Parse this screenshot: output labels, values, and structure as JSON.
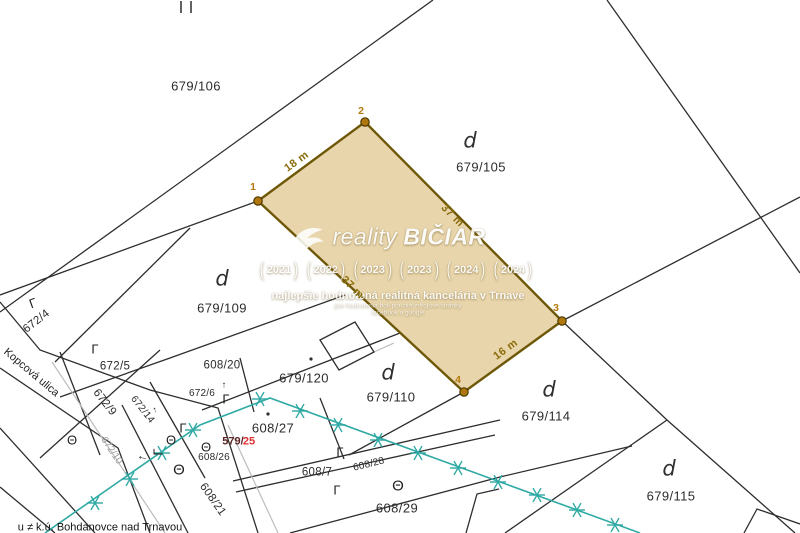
{
  "watermark": {
    "brand_prefix": "reality",
    "brand_suffix": "BIČIAR",
    "badges": [
      "2021",
      "2022",
      "2023",
      "2023",
      "2024",
      "2024"
    ],
    "slogan": "najlepšie hodnotená realitná kancelária v Trnave",
    "fine_print_line1": "pre hodnotenia boli použité zdrojové stránky",
    "fine_print_line2": "facebook a google"
  },
  "colors": {
    "parcel_fill": "#e8d5ab",
    "parcel_edge": "#6e5808",
    "corner_marker": "#b0770e",
    "utility_line": "#2fa9a4",
    "dimension_text": "#8a6d0a",
    "highlight_red": "#e03131",
    "boundary_line": "#2e2e2e",
    "road_gray": "#bdbdbd"
  },
  "labels": [
    {
      "t": "679/106",
      "x": 196,
      "y": 86,
      "c": "num",
      "n": "parcel-number-679-106"
    },
    {
      "t": "679/105",
      "x": 481,
      "y": 167,
      "c": "num",
      "n": "parcel-number-679-105"
    },
    {
      "t": "679/109",
      "x": 222,
      "y": 308,
      "c": "num",
      "n": "parcel-number-679-109"
    },
    {
      "t": "679/110",
      "x": 391,
      "y": 397,
      "c": "num",
      "n": "parcel-number-679-110"
    },
    {
      "t": "679/114",
      "x": 546,
      "y": 416,
      "c": "num",
      "n": "parcel-number-679-114"
    },
    {
      "t": "679/115",
      "x": 671,
      "y": 496,
      "c": "num",
      "n": "parcel-number-679-115"
    },
    {
      "t": "679/120",
      "x": 304,
      "y": 378,
      "c": "num",
      "n": "parcel-number-679-120"
    },
    {
      "t": "608/20",
      "x": 222,
      "y": 366,
      "c": "num-s",
      "n": "parcel-number-608-20"
    },
    {
      "t": "608/27",
      "x": 273,
      "y": 428,
      "c": "num",
      "n": "parcel-number-608-27"
    },
    {
      "t": "608/26",
      "x": 214,
      "y": 458,
      "c": "num-xs",
      "n": "parcel-number-608-26"
    },
    {
      "t": "608/7",
      "x": 317,
      "y": 473,
      "c": "num-s",
      "n": "parcel-number-608-7"
    },
    {
      "t": "608/29",
      "x": 397,
      "y": 508,
      "c": "num",
      "n": "parcel-number-608-29"
    },
    {
      "t": "608/28",
      "x": 369,
      "y": 465,
      "r": -14,
      "c": "num-xs",
      "n": "parcel-number-608-28"
    },
    {
      "t": "608/21",
      "x": 212,
      "y": 500,
      "r": 55,
      "c": "num-s",
      "n": "parcel-number-608-21"
    },
    {
      "t": "672/4",
      "x": 37,
      "y": 322,
      "r": -38,
      "c": "num-s",
      "n": "parcel-number-672-4"
    },
    {
      "t": "672/5",
      "x": 115,
      "y": 367,
      "c": "num-s",
      "n": "parcel-number-672-5"
    },
    {
      "t": "672/9",
      "x": 104,
      "y": 403,
      "r": 52,
      "c": "num-s",
      "n": "parcel-number-672-9"
    },
    {
      "t": "672/14",
      "x": 142,
      "y": 410,
      "r": 52,
      "c": "num-xs",
      "n": "parcel-number-672-14"
    },
    {
      "t": "672/6",
      "x": 202,
      "y": 394,
      "c": "num-xs",
      "n": "parcel-number-672-6"
    },
    {
      "t": "672/10",
      "x": 111,
      "y": 451,
      "r": 56,
      "c": "gray-s",
      "n": "path-number-672-10"
    },
    {
      "t": "Kopcová ulica",
      "x": 31,
      "y": 373,
      "r": 40,
      "c": "street",
      "n": "street-name-kopcova-ulica"
    },
    {
      "t": "579/",
      "x": 233,
      "y": 442,
      "c": "bold-dark",
      "n": "parcel-number-579-25-prefix"
    },
    {
      "t": "25",
      "x": 249,
      "y": 442,
      "c": "bold-red",
      "n": "parcel-number-579-25-red"
    },
    {
      "t": "d",
      "x": 470,
      "y": 141,
      "c": "dl",
      "n": "land-use-letter-d"
    },
    {
      "t": "d",
      "x": 222,
      "y": 279,
      "c": "dl",
      "n": "land-use-letter-d"
    },
    {
      "t": "d",
      "x": 388,
      "y": 373,
      "c": "dl",
      "n": "land-use-letter-d"
    },
    {
      "t": "d",
      "x": 549,
      "y": 390,
      "c": "dl",
      "n": "land-use-letter-d"
    },
    {
      "t": "d",
      "x": 669,
      "y": 469,
      "c": "dl",
      "n": "land-use-letter-d"
    },
    {
      "t": "18 m",
      "x": 297,
      "y": 162,
      "r": -36,
      "c": "dim",
      "n": "dimension-18m"
    },
    {
      "t": "37 m",
      "x": 452,
      "y": 216,
      "r": 45,
      "c": "dim",
      "n": "dimension-37m"
    },
    {
      "t": "37 m",
      "x": 352,
      "y": 288,
      "r": 45,
      "c": "dim",
      "n": "dimension-37m-left"
    },
    {
      "t": "16 m",
      "x": 506,
      "y": 350,
      "r": -36,
      "c": "dim",
      "n": "dimension-16m"
    },
    {
      "t": "1",
      "x": 253,
      "y": 187,
      "c": "corner",
      "n": "corner-point-label-1"
    },
    {
      "t": "2",
      "x": 361,
      "y": 111,
      "c": "corner",
      "n": "corner-point-label-2"
    },
    {
      "t": "3",
      "x": 556,
      "y": 308,
      "c": "corner",
      "n": "corner-point-label-3"
    },
    {
      "t": "4",
      "x": 458,
      "y": 380,
      "c": "corner",
      "n": "corner-point-label-4"
    },
    {
      "t": "Γ",
      "x": 33,
      "y": 303,
      "r": -20,
      "c": "sym",
      "n": "land-use-symbol-gamma"
    },
    {
      "t": "Γ",
      "x": 95,
      "y": 349,
      "c": "sym",
      "n": "land-use-symbol-gamma"
    },
    {
      "t": "Γ",
      "x": 226,
      "y": 399,
      "c": "sym",
      "n": "land-use-symbol-gamma"
    },
    {
      "t": "Γ",
      "x": 183,
      "y": 428,
      "c": "sym",
      "n": "land-use-symbol-gamma"
    },
    {
      "t": "Γ",
      "x": 158,
      "y": 452,
      "r": -90,
      "c": "sym",
      "n": "land-use-symbol-gamma"
    },
    {
      "t": "Γ",
      "x": 340,
      "y": 452,
      "c": "sym",
      "n": "land-use-symbol-gamma"
    },
    {
      "t": "Γ",
      "x": 337,
      "y": 490,
      "c": "sym",
      "n": "land-use-symbol-gamma"
    },
    {
      "t": "Θ",
      "x": 206,
      "y": 447,
      "c": "sym",
      "n": "land-use-symbol-theta"
    },
    {
      "t": "Θ",
      "x": 179,
      "y": 470,
      "c": "sym-lg",
      "n": "land-use-symbol-theta"
    },
    {
      "t": "Θ",
      "x": 72,
      "y": 440,
      "c": "sym",
      "n": "land-use-symbol-theta"
    },
    {
      "t": "Θ",
      "x": 171,
      "y": 440,
      "c": "sym",
      "n": "land-use-symbol-theta"
    },
    {
      "t": "Θ",
      "x": 398,
      "y": 486,
      "c": "sym-lg",
      "n": "land-use-symbol-theta"
    },
    {
      "t": "←",
      "x": 143,
      "y": 456,
      "r": 12,
      "c": "arrow",
      "n": "direction-arrow-left"
    },
    {
      "t": "↑",
      "x": 224,
      "y": 385,
      "c": "arrow-s",
      "n": "direction-arrow-up"
    },
    {
      "t": "↑",
      "x": 155,
      "y": 410,
      "r": -20,
      "c": "arrow-s",
      "n": "direction-arrow-up"
    },
    {
      "t": "u ≠ k.ú. Bohdanovce nad Trnavou",
      "x": 100,
      "y": 528,
      "c": "note",
      "n": "cadastral-boundary-note"
    }
  ]
}
